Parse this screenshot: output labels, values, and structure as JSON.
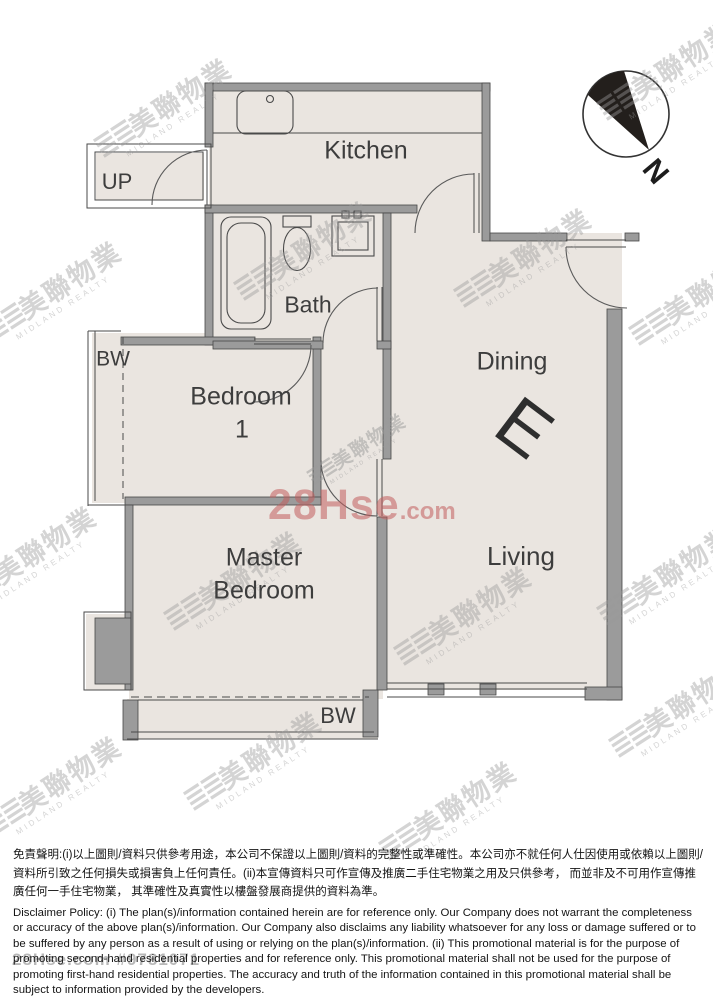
{
  "floor_plan": {
    "rooms": {
      "kitchen": "Kitchen",
      "bath": "Bath",
      "bedroom1_line1": "Bedroom",
      "bedroom1_line2": "1",
      "dining": "Dining",
      "living": "Living",
      "master_line1": "Master",
      "master_line2": "Bedroom"
    },
    "labels": {
      "up": "UP",
      "bay_window_left": "BW",
      "bay_window_bottom": "BW",
      "unit_letter": "E",
      "north": "N"
    },
    "colors": {
      "floor_fill": "#eae5e0",
      "wall_fill": "#9b9b9b",
      "line": "#4a4a4a",
      "north_arrow": "#231f1c"
    }
  },
  "watermarks": {
    "midland_bars": "≣≣",
    "midland_text": "美聯物業",
    "midland_caption": "MIDLAND REALTY",
    "site_main": "28Hse",
    "site_suffix": ".com",
    "site_footer": "28Hse.com #9781071",
    "colors": {
      "midland_gray": "#9a9a9a",
      "site_red": "#c15c5c"
    }
  },
  "disclaimer": {
    "chinese": "免責聲明:(i)以上圖則/資料只供參考用途，本公司不保證以上圖則/資料的完整性或準確性。本公司亦不就任何人仕因使用或依賴以上圖則/資料所引致之任何損失或損害負上任何責任。(ii)本宣傳資料只可作宣傳及推廣二手住宅物業之用及只供參考， 而並非及不可用作宣傳推廣任何一手住宅物業， 其準確性及真實性以樓盤發展商提供的資料為準。",
    "english": "Disclaimer Policy: (i) The plan(s)/information contained herein are for reference only. Our Company does not warrant the completeness or accuracy of the above plan(s)/information. Our Company also disclaims any liability whatsoever for any loss or damage suffered or to be suffered by any person as a result of using or relying on the plan(s)/information. (ii) This promotional material is for the purpose of promoting second-hand residential properties and for reference only. This promotional material shall not be used for the purpose of promoting first-hand residential properties. The accuracy and truth of the information contained in this promotional material shall be subject to information provided by the developers."
  }
}
